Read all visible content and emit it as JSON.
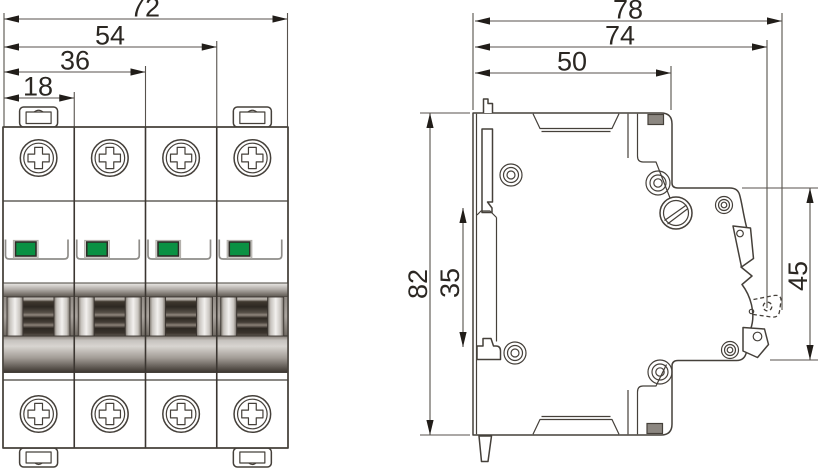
{
  "front_view": {
    "dimensions": {
      "total_width": "72",
      "three_modules": "54",
      "two_modules": "36",
      "one_module": "18"
    },
    "module_count": 4
  },
  "side_view": {
    "dimensions": {
      "overall_depth_max": "78",
      "overall_depth": "74",
      "body_depth": "50",
      "height": "82",
      "din_rail_recess": "35",
      "front_face_height": "45"
    }
  },
  "colors": {
    "indicator_green": "#0a9143"
  }
}
